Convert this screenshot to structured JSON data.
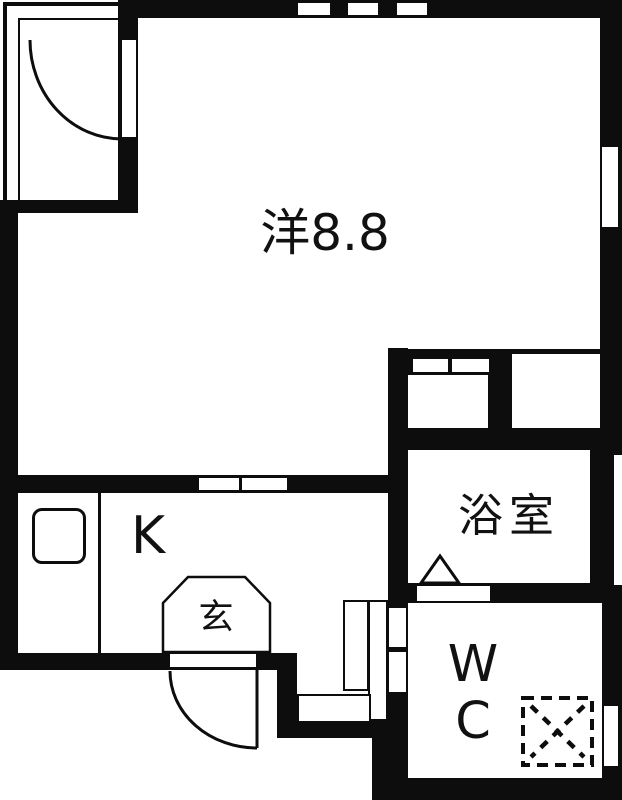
{
  "plan_title": "1K apartment floor plan",
  "rooms": {
    "living": {
      "label": "洋8.8"
    },
    "kitchen": {
      "label": "K"
    },
    "entrance": {
      "label": "玄"
    },
    "bathroom": {
      "label": "浴室"
    },
    "toilet": {
      "line1": "W",
      "line2": "C"
    }
  },
  "symbols": {
    "closet_door": "hinged-door-arc",
    "entry_door": "hinged-door-arc",
    "kitchen_door": "sliding-door-two-panels",
    "storage_door": "sliding-door-two-panels",
    "bath_door_mark": "triangle",
    "washer_space": "dashed-box-with-x",
    "sink": "rounded-square",
    "windows": "white-slots-in-wall"
  },
  "colors": {
    "wall": "#0d0d0d",
    "floor": "#ffffff",
    "text": "#111111"
  }
}
